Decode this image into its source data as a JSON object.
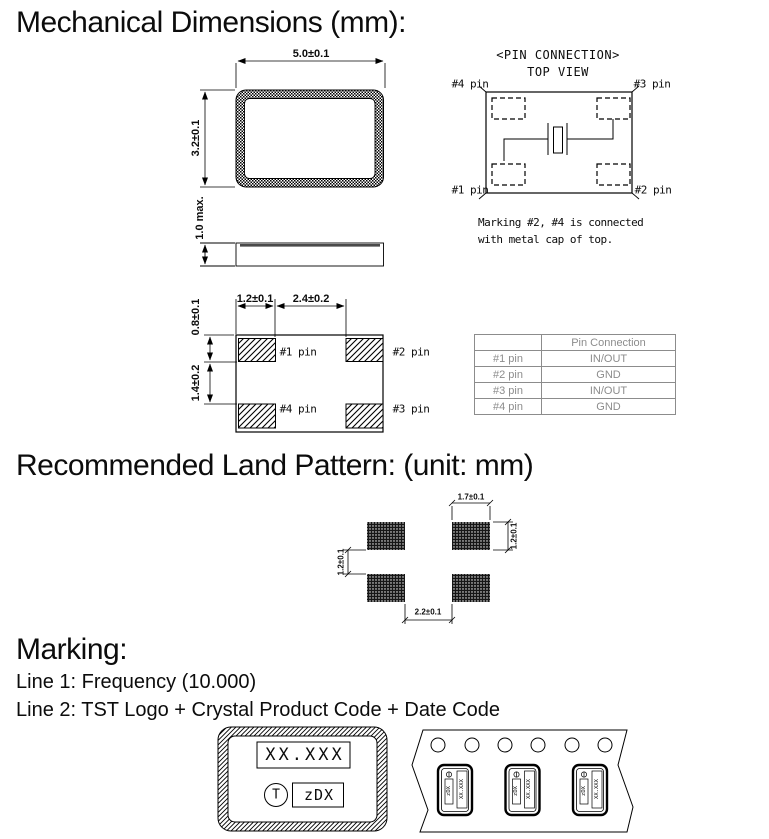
{
  "headings": {
    "mechanical": "Mechanical Dimensions (mm):",
    "land_pattern": "Recommended Land Pattern: (unit: mm)",
    "marking": "Marking:"
  },
  "marking_lines": {
    "line1": "Line 1: Frequency (10.000)",
    "line2": "Line 2: TST Logo + Crystal Product Code + Date Code"
  },
  "top_view": {
    "width_dim": "5.0±0.1",
    "height_dim": "3.2±0.1",
    "thickness_dim": "1.0 max."
  },
  "pin_connection": {
    "title": "<PIN CONNECTION>",
    "subtitle": "TOP VIEW",
    "note_line1": "Marking #2, #4 is connected",
    "note_line2": "with metal cap of top."
  },
  "pin_labels": {
    "p1": "#1 pin",
    "p2": "#2 pin",
    "p3": "#3 pin",
    "p4": "#4 pin"
  },
  "bottom_view": {
    "pad_width_dim": "1.2±0.1",
    "pad_gap_dim": "2.4±0.2",
    "pad_height_dim": "0.8±0.1",
    "pad_vgap_dim": "1.4±0.2"
  },
  "pin_table": {
    "header": [
      "",
      "Pin Connection"
    ],
    "rows": [
      [
        "#1 pin",
        "IN/OUT"
      ],
      [
        "#2 pin",
        "GND"
      ],
      [
        "#3 pin",
        "IN/OUT"
      ],
      [
        "#4 pin",
        "GND"
      ]
    ]
  },
  "land_pattern": {
    "pad_width_dim": "1.7±0.1",
    "pad_height_dim": "1.2±0.1",
    "row_gap_dim": "1.2±0.1",
    "col_gap_dim": "2.2±0.1"
  },
  "marking_example": {
    "line1": "XX.XXX",
    "logo": "T",
    "code": "zDX"
  },
  "colors": {
    "line": "#000000",
    "table_gray": "#8c8c8c",
    "background": "#ffffff"
  }
}
